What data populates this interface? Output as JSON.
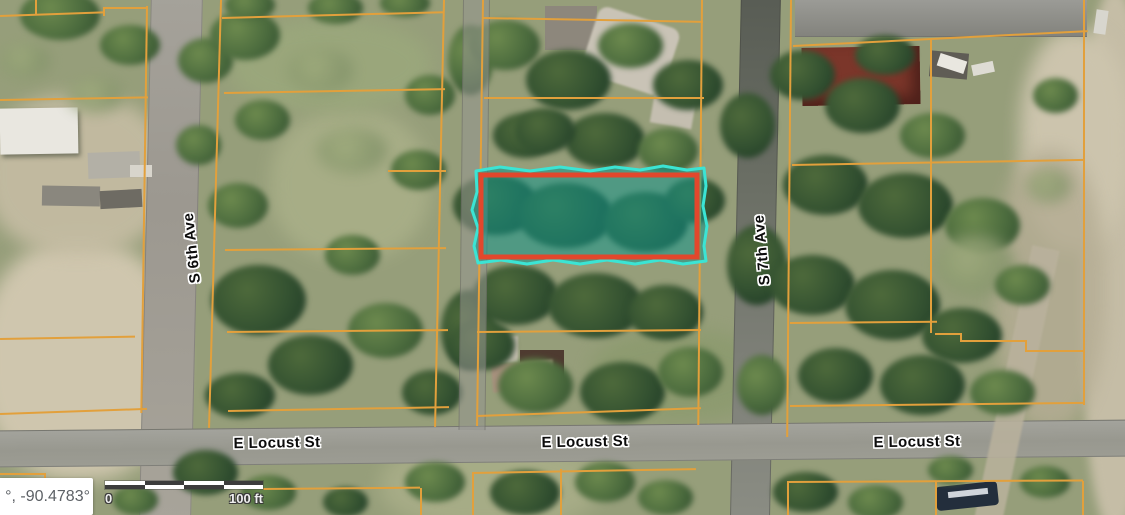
{
  "map": {
    "street_labels": [
      {
        "id": "s-6th-ave",
        "text": "S 6th Ave"
      },
      {
        "id": "s-7th-ave",
        "text": "S 7th Ave"
      },
      {
        "id": "e-locust-west",
        "text": "E Locust St"
      },
      {
        "id": "e-locust-center",
        "text": "E Locust St"
      },
      {
        "id": "e-locust-east",
        "text": "E Locust St"
      }
    ],
    "scale_bar": {
      "start_label": "0",
      "end_label": "100 ft"
    },
    "coordinates_readout": "°, -90.4783°",
    "colors": {
      "parcel_line": "#e2a03c",
      "highlight_fill": "#0f968c",
      "highlight_outline_cyan": "#3be4d4",
      "highlight_border_red": "#e2472c"
    },
    "highlighted_parcel": {
      "status": "selected"
    }
  }
}
